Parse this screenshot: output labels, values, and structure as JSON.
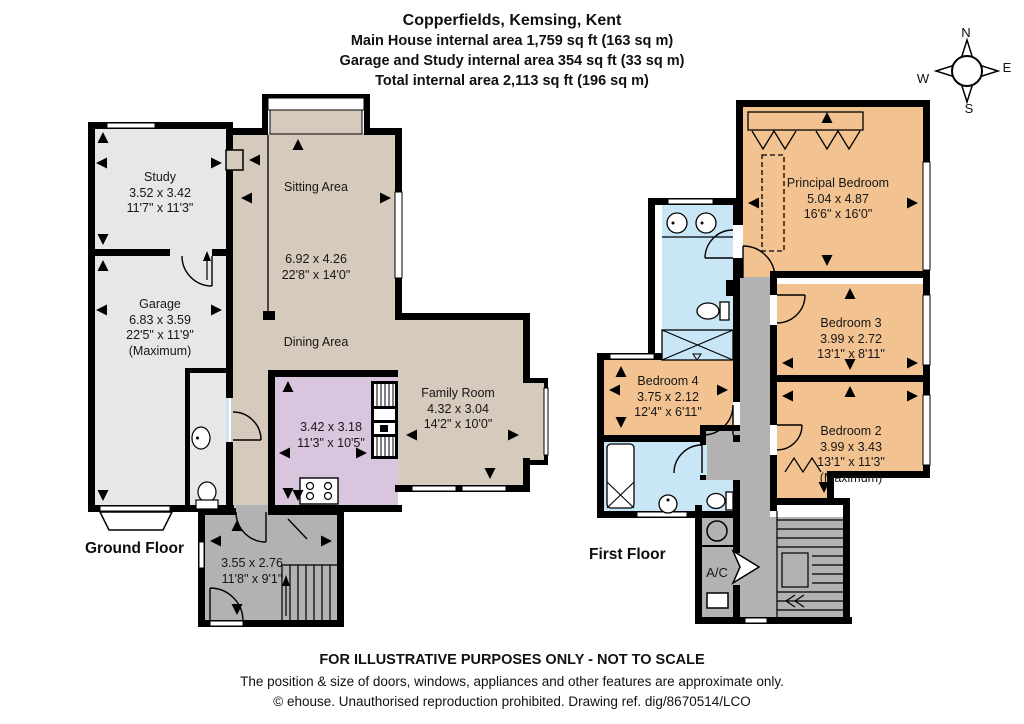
{
  "header": {
    "title": "Copperfields, Kemsing, Kent",
    "line1": "Main House internal area 1,759 sq ft (163 sq m)",
    "line2": "Garage and Study internal area 354 sq ft (33 sq m)",
    "line3": "Total internal area 2,113 sq ft (196 sq m)"
  },
  "compass": {
    "n": "N",
    "e": "E",
    "s": "S",
    "w": "W"
  },
  "floors": {
    "ground": {
      "label": "Ground Floor",
      "rooms": {
        "study": {
          "name": "Study",
          "metric": "3.52 x 3.42",
          "imperial": "11'7\" x 11'3\""
        },
        "garage": {
          "name": "Garage",
          "metric": "6.83 x 3.59",
          "imperial": "22'5\" x 11'9\"",
          "note": "(Maximum)"
        },
        "sitting": {
          "name": "Sitting Area",
          "metric": "6.92 x 4.26",
          "imperial": "22'8\" x 14'0\""
        },
        "dining": {
          "name": "Dining Area"
        },
        "kitchen": {
          "metric": "3.42 x 3.18",
          "imperial": "11'3\" x 10'5\""
        },
        "family": {
          "name": "Family Room",
          "metric": "4.32 x 3.04",
          "imperial": "14'2\" x 10'0\""
        },
        "hall": {
          "metric": "3.55 x 2.76",
          "imperial": "11'8\" x 9'1\""
        }
      }
    },
    "first": {
      "label": "First Floor",
      "rooms": {
        "principal": {
          "name": "Principal Bedroom",
          "metric": "5.04 x 4.87",
          "imperial": "16'6\" x 16'0\""
        },
        "bedroom3": {
          "name": "Bedroom 3",
          "metric": "3.99 x 2.72",
          "imperial": "13'1\" x 8'11\""
        },
        "bedroom2": {
          "name": "Bedroom 2",
          "metric": "3.99 x 3.43",
          "imperial": "13'1\" x 11'3\"",
          "note": "(Maximum)"
        },
        "bedroom4": {
          "name": "Bedroom 4",
          "metric": "3.75 x 2.12",
          "imperial": "12'4\" x 6'11\""
        },
        "ac": {
          "label": "A/C"
        }
      }
    }
  },
  "footer": {
    "line1": "FOR ILLUSTRATIVE PURPOSES ONLY - NOT TO SCALE",
    "line2": "The position & size of doors, windows, appliances and other features are approximate only.",
    "line3": "© ehouse. Unauthorised reproduction prohibited. Drawing ref. dig/8670514/LCO"
  },
  "colors": {
    "wall": "#000000",
    "living_area": "#d5cabb",
    "garage_study": "#e7e7e7",
    "kitchen": "#d9c6de",
    "bedroom": "#f2c391",
    "bathroom": "#c9e6f7",
    "hall_landing": "#b2b2b2",
    "window": "#ffffff"
  }
}
